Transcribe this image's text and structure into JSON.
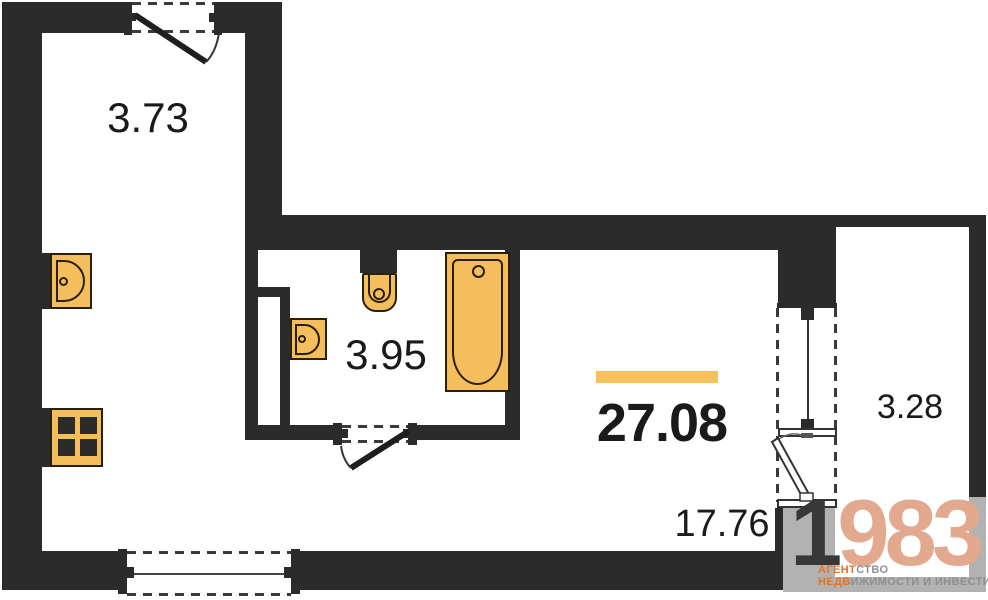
{
  "areas": {
    "hall": "3.73",
    "bathroom": "3.95",
    "total": "27.08",
    "living": "17.76",
    "balcony": "3.28"
  },
  "logo": {
    "number_dark": "1",
    "number_light": "983",
    "line1_orange": "АГЕНТ",
    "line1_gray": "СТВО",
    "line2_orange": "НЕДВ",
    "line2_gray": "ИЖИМОСТИ И ИНВЕСТИЦИЙ"
  },
  "colors": {
    "wall": "#2B2B2B",
    "balcony_gray_wall": "#B2B2B2",
    "fixture_fill": "#F5BE5C",
    "fixture_border": "#2A2008",
    "accent_bar": "#F7C05A",
    "label_text": "#1A1A1A",
    "logo_number_dark": "#383838",
    "logo_number_light": "#E2A98E",
    "logo_orange": "#E8721C",
    "logo_gray": "#8F8F8F"
  },
  "fixtures": {
    "kitchen_sink": "kitchen-sink",
    "stove": "stove-4-burner",
    "toilet": "toilet",
    "washbasin": "washbasin",
    "bathtub": "bathtub"
  }
}
